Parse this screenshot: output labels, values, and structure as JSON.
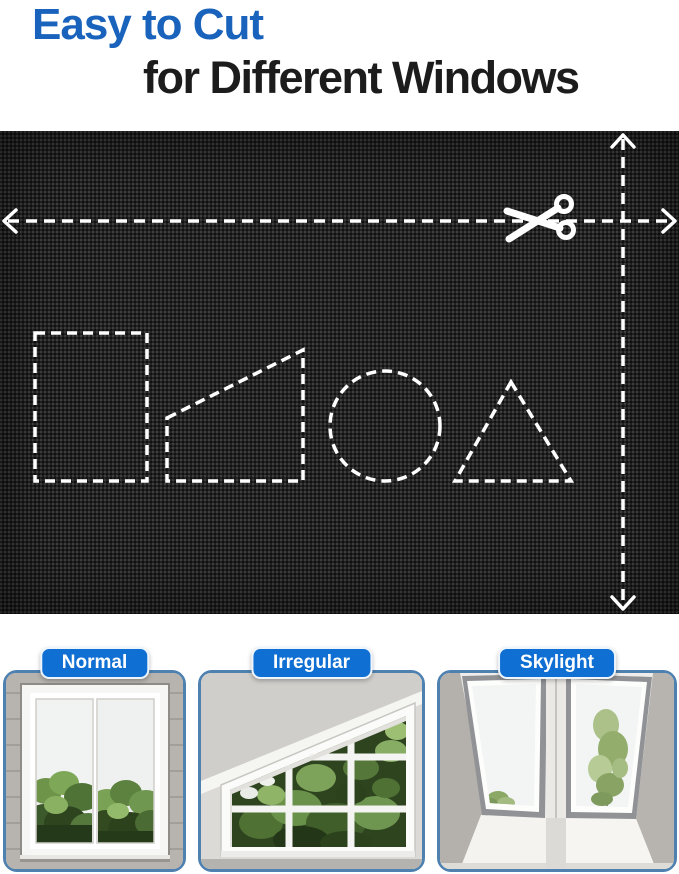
{
  "header": {
    "title_line1": "Easy to Cut",
    "title_line2": "for Different Windows",
    "title_line1_color": "#1a63bc",
    "title_line2_color": "#1c1c1c"
  },
  "fabric_panel": {
    "description_icons": [
      "scissors-icon",
      "dashed-width-arrow",
      "dashed-height-arrow"
    ],
    "cut_shapes": [
      "rectangle",
      "right-trapezoid",
      "circle",
      "triangle"
    ],
    "fabric_color": "#232323",
    "dash_color": "#ffffff"
  },
  "window_types": [
    {
      "label": "Normal"
    },
    {
      "label": "Irregular"
    },
    {
      "label": "Skylight"
    }
  ],
  "colors": {
    "label_pill_blue": "#0f6fd3",
    "card_border_blue": "#4e81b0"
  }
}
